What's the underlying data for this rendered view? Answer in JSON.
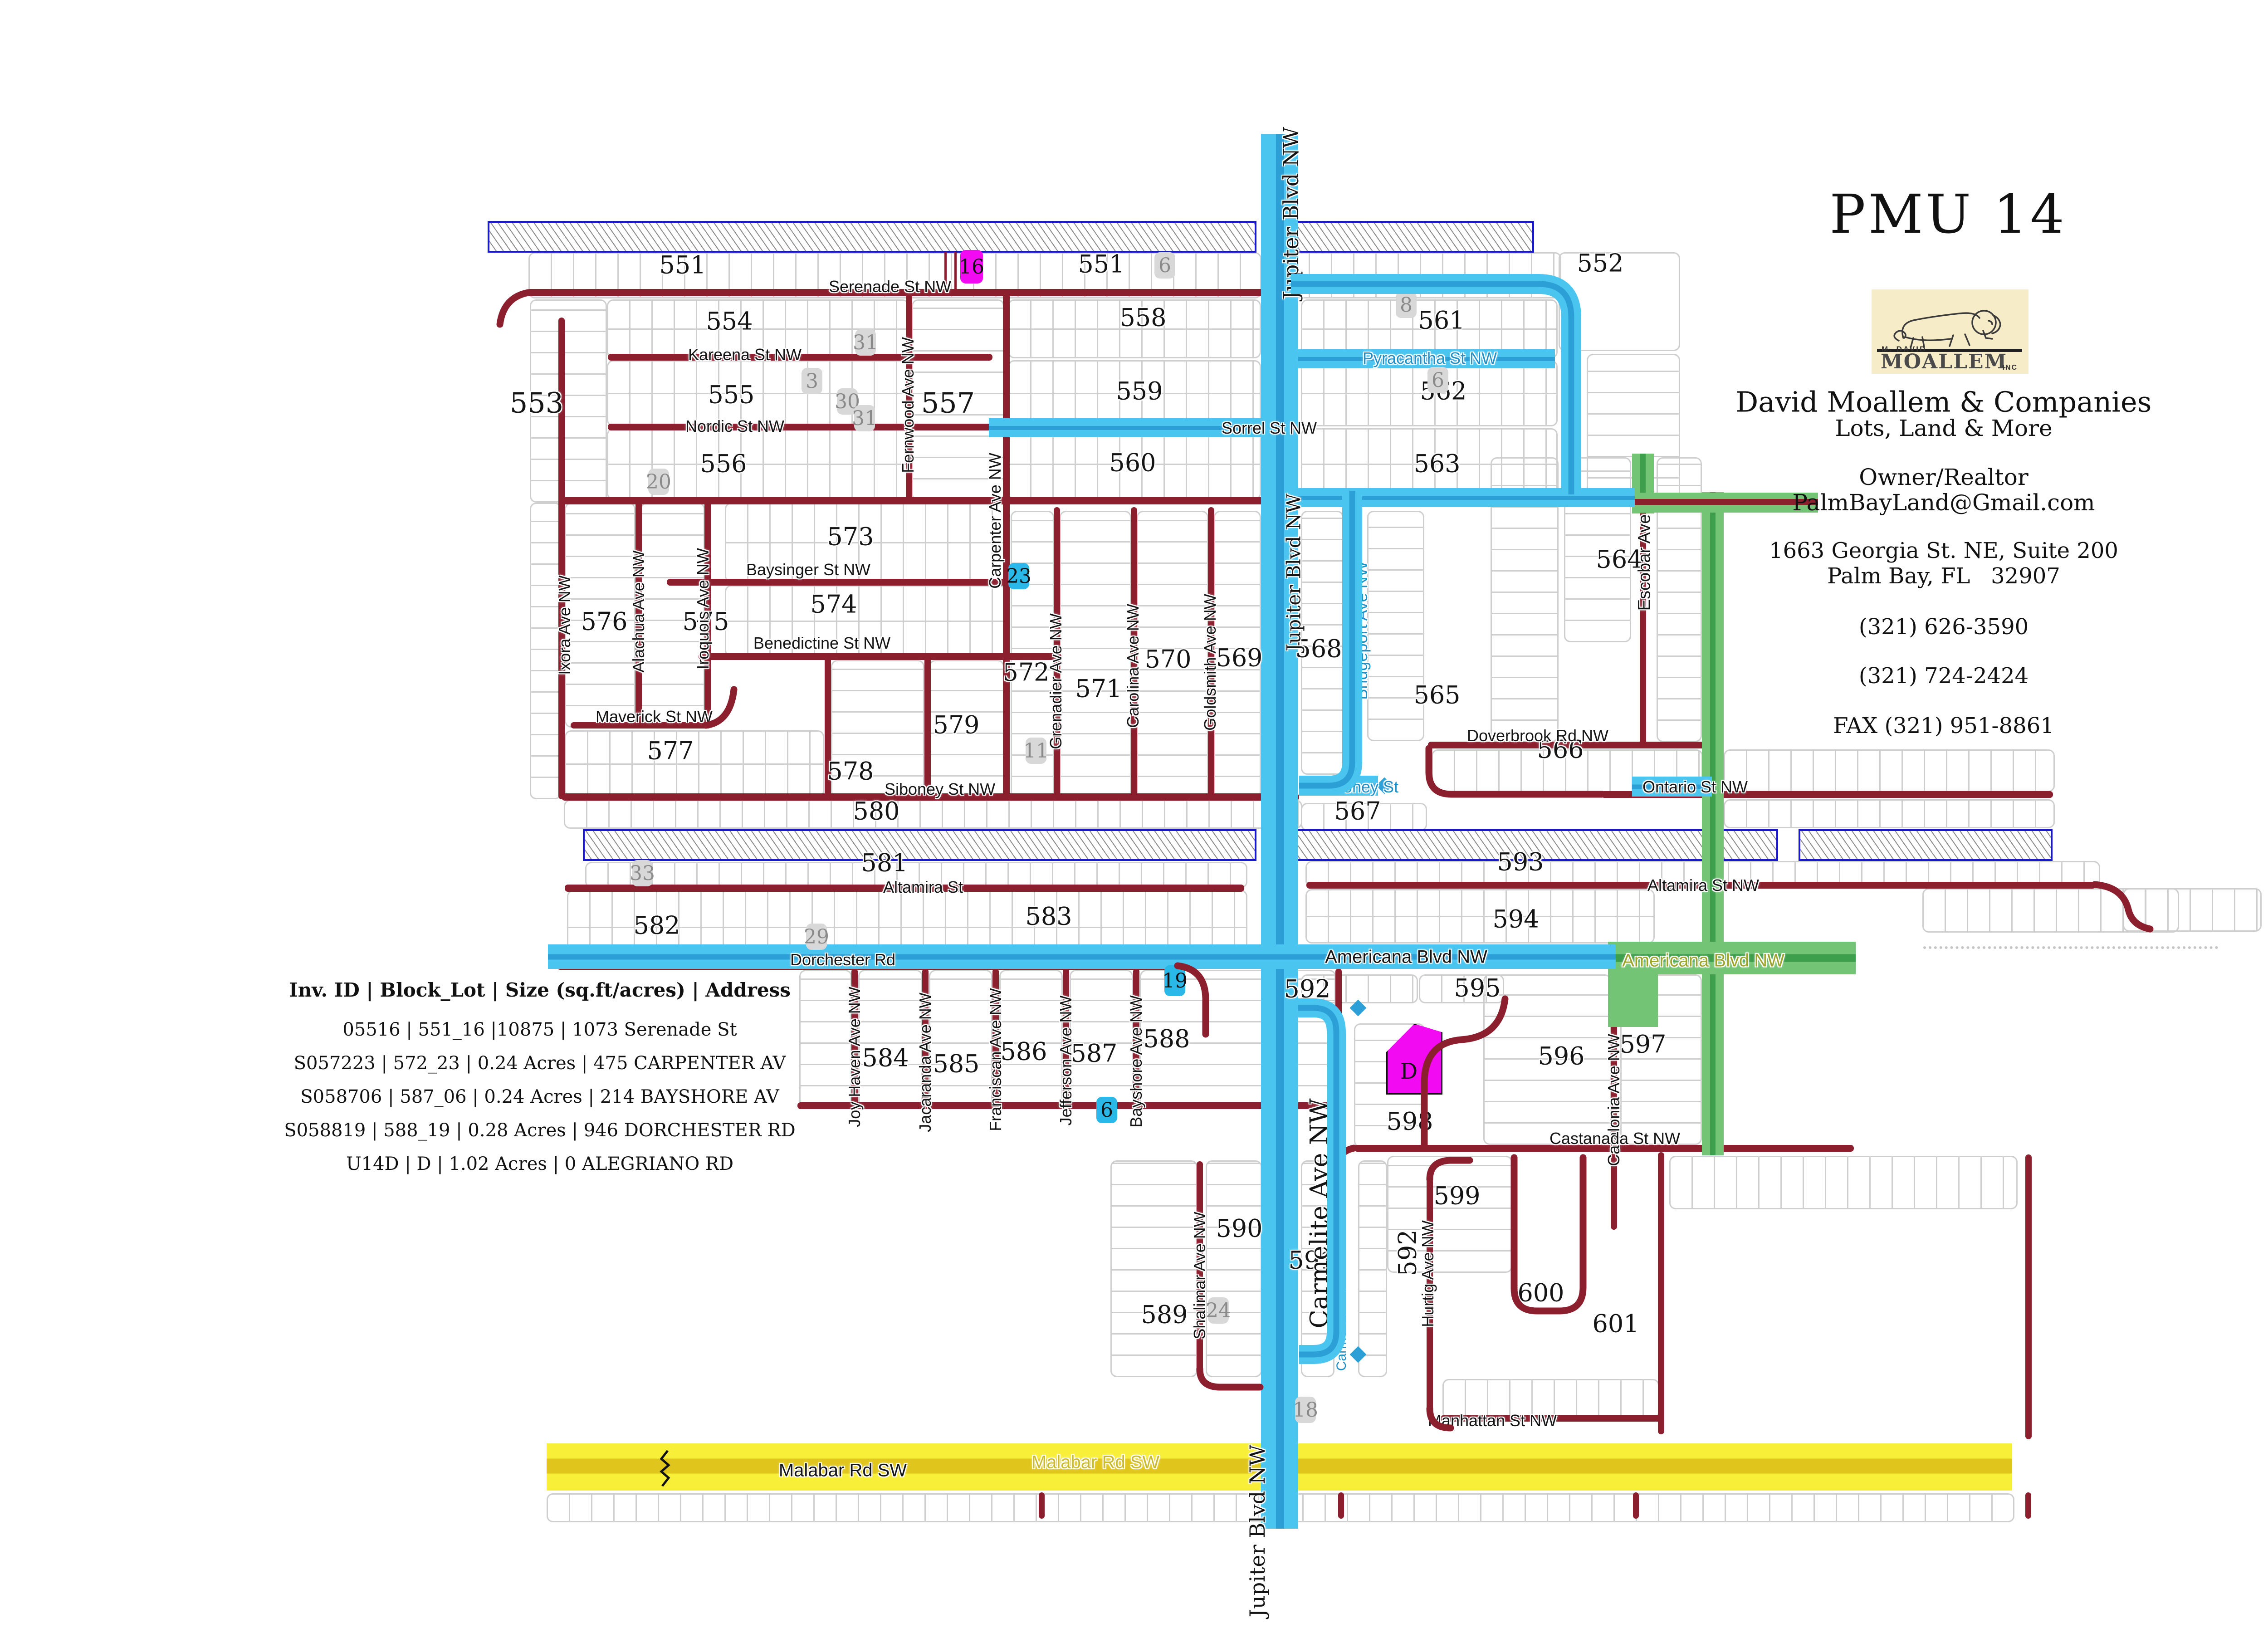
{
  "title": "PMU 14",
  "logo": {
    "top": "M. DAVID",
    "name": "MOALLEM",
    "inc": "INC"
  },
  "company": {
    "lines": [
      "David Moallem & Companies",
      "Lots, Land & More",
      "Owner/Realtor",
      "PalmBayLand@Gmail.com",
      "1663 Georgia St. NE, Suite 200",
      "Palm Bay, FL   32907",
      "(321) 626-3590",
      "(321) 724-2424",
      "FAX (321) 951-8861"
    ]
  },
  "inventory": {
    "header": "Inv. ID | Block_Lot | Size (sq.ft/acres) | Address",
    "rows": [
      "05516 |  551_16 |10875  | 1073 Serenade St",
      "S057223 | 572_23 | 0.24 Acres | 475 CARPENTER AV",
      "S058706 | 587_06 | 0.24 Acres | 214 BAYSHORE AV",
      "S058819 | 588_19 | 0.28 Acres | 946 DORCHESTER RD",
      "U14D | D |  1.02 Acres  | 0 ALEGRIANO RD"
    ]
  },
  "map": {
    "colors": {
      "highlight_blue": "#49C5EF",
      "highlight_blue_core": "#2B9FD6",
      "highlight_green": "#74C475",
      "highlight_green_core": "#3D9E4B",
      "road_red": "#8B1F2E",
      "malabar_yellow": "#F8EF39",
      "malabar_core": "#E0C61C",
      "canal_border_blue": "#1818CF",
      "lot_gray": "#D8D8D8",
      "lot_cyan": "#29B8E8",
      "lot_magenta": "#F20AF2",
      "grid_gray": "#CFCFCF"
    },
    "block_labels": [
      {
        "id": "b551a",
        "text": "551"
      },
      {
        "id": "b551b",
        "text": "551"
      },
      {
        "id": "b552",
        "text": "552"
      },
      {
        "id": "b553",
        "text": "553"
      },
      {
        "id": "b554",
        "text": "554"
      },
      {
        "id": "b555",
        "text": "555"
      },
      {
        "id": "b556",
        "text": "556"
      },
      {
        "id": "b557",
        "text": "557"
      },
      {
        "id": "b558",
        "text": "558"
      },
      {
        "id": "b559",
        "text": "559"
      },
      {
        "id": "b560",
        "text": "560"
      },
      {
        "id": "b561",
        "text": "561"
      },
      {
        "id": "b562",
        "text": "562"
      },
      {
        "id": "b563",
        "text": "563"
      },
      {
        "id": "b564",
        "text": "564"
      },
      {
        "id": "b565",
        "text": "565"
      },
      {
        "id": "b566",
        "text": "566"
      },
      {
        "id": "b567",
        "text": "567"
      },
      {
        "id": "b568",
        "text": "568"
      },
      {
        "id": "b569",
        "text": "569"
      },
      {
        "id": "b570",
        "text": "570"
      },
      {
        "id": "b571",
        "text": "571"
      },
      {
        "id": "b572",
        "text": "572"
      },
      {
        "id": "b573",
        "text": "573"
      },
      {
        "id": "b574",
        "text": "574"
      },
      {
        "id": "b575",
        "text": "575"
      },
      {
        "id": "b576",
        "text": "576"
      },
      {
        "id": "b577",
        "text": "577"
      },
      {
        "id": "b578",
        "text": "578"
      },
      {
        "id": "b579",
        "text": "579"
      },
      {
        "id": "b580",
        "text": "580"
      },
      {
        "id": "b581",
        "text": "581"
      },
      {
        "id": "b582",
        "text": "582"
      },
      {
        "id": "b583",
        "text": "583"
      },
      {
        "id": "b584",
        "text": "584"
      },
      {
        "id": "b585",
        "text": "585"
      },
      {
        "id": "b586",
        "text": "586"
      },
      {
        "id": "b587",
        "text": "587"
      },
      {
        "id": "b588",
        "text": "588"
      },
      {
        "id": "b589",
        "text": "589"
      },
      {
        "id": "b590",
        "text": "590"
      },
      {
        "id": "b591",
        "text": "591"
      },
      {
        "id": "b592a",
        "text": "592"
      },
      {
        "id": "b592b",
        "text": "592"
      },
      {
        "id": "b593",
        "text": "593"
      },
      {
        "id": "b594",
        "text": "594"
      },
      {
        "id": "b595",
        "text": "595"
      },
      {
        "id": "b596",
        "text": "596"
      },
      {
        "id": "b597",
        "text": "597"
      },
      {
        "id": "b598",
        "text": "598"
      },
      {
        "id": "b599",
        "text": "599"
      },
      {
        "id": "b600",
        "text": "600"
      },
      {
        "id": "b601",
        "text": "601"
      }
    ],
    "street_labels": [
      {
        "id": "sSerenade",
        "text": "Serenade St NW"
      },
      {
        "id": "sKareena",
        "text": "Kareena St NW"
      },
      {
        "id": "sNordic",
        "text": "Nordic St NW"
      },
      {
        "id": "sFernwood",
        "text": "Fernwood Ave NW"
      },
      {
        "id": "sCarpenter",
        "text": "Carpenter Ave NW"
      },
      {
        "id": "sBaysinger",
        "text": "Baysinger St NW"
      },
      {
        "id": "sBenedictine",
        "text": "Benedictine St NW"
      },
      {
        "id": "sIxora",
        "text": "Ixora Ave NW"
      },
      {
        "id": "sAlachua",
        "text": "Alachua Ave NW"
      },
      {
        "id": "sIroquois",
        "text": "Iroquois Ave NW"
      },
      {
        "id": "sMaverick",
        "text": "Maverick St NW"
      },
      {
        "id": "sSiboneyNW",
        "text": "Siboney St NW"
      },
      {
        "id": "sGrenadier",
        "text": "Grenadier Ave NW"
      },
      {
        "id": "sCarolina",
        "text": "Carolina Ave NW"
      },
      {
        "id": "sGoldsmith",
        "text": "Goldsmith Ave NW"
      },
      {
        "id": "sJupiterTop",
        "text": "Jupiter Blvd NW"
      },
      {
        "id": "sJupiterMid",
        "text": "Jupiter Blvd NW"
      },
      {
        "id": "sJupiterBot",
        "text": "Jupiter Blvd NW"
      },
      {
        "id": "sBridgeport",
        "text": "Bridgeport Ave NW"
      },
      {
        "id": "sAdventure",
        "text": "Adventure Ave NW"
      },
      {
        "id": "sPyracantha",
        "text": "Pyracantha St NW"
      },
      {
        "id": "sSorrel",
        "text": "Sorrel St NW"
      },
      {
        "id": "sSiboneyBlue",
        "text": "Siboney St"
      },
      {
        "id": "sEscobar",
        "text": "Escobar Ave"
      },
      {
        "id": "sDoverbrook",
        "text": "Doverbrook Rd NW"
      },
      {
        "id": "sOntario",
        "text": "Ontario St NW"
      },
      {
        "id": "sAltamira",
        "text": "Altamira St"
      },
      {
        "id": "sAltamiraNW",
        "text": "Altamira St NW"
      },
      {
        "id": "sDorchester",
        "text": "Dorchester Rd"
      },
      {
        "id": "sAmericanaBlk",
        "text": "Americana Blvd NW"
      },
      {
        "id": "sAmericanaGrn",
        "text": "Americana Blvd NW"
      },
      {
        "id": "sJoyHaven",
        "text": "Joy Haven Ave NW"
      },
      {
        "id": "sJacaranda",
        "text": "Jacaranda Ave NW"
      },
      {
        "id": "sFranciscan",
        "text": "Franciscan Ave NW"
      },
      {
        "id": "sJefferson",
        "text": "Jefferson Ave NW"
      },
      {
        "id": "sBayshore",
        "text": "Bayshore Ave NW"
      },
      {
        "id": "sShalimar",
        "text": "Shalimar Ave NW"
      },
      {
        "id": "sCarmeliteBig",
        "text": "Carmelite Ave NW"
      },
      {
        "id": "sCarmeliteBlue",
        "text": "Carmelite Ave NW"
      },
      {
        "id": "sCatalonia",
        "text": "Catalonia Ave NW"
      },
      {
        "id": "sHurtig",
        "text": "Hurtig Ave NW"
      },
      {
        "id": "sCastanada",
        "text": "Castanada St NW"
      },
      {
        "id": "sManhattan",
        "text": "Manhattan St NW"
      },
      {
        "id": "sMalabarBlk",
        "text": "Malabar Rd SW"
      },
      {
        "id": "sMalabarOlv",
        "text": "Malabar Rd SW"
      }
    ],
    "lot_markers": [
      {
        "id": "m16",
        "text": "16",
        "type": "magenta"
      },
      {
        "id": "m6a",
        "text": "6",
        "type": "gray"
      },
      {
        "id": "m8",
        "text": "8",
        "type": "gray"
      },
      {
        "id": "m31a",
        "text": "31",
        "type": "gray"
      },
      {
        "id": "m3",
        "text": "3",
        "type": "gray"
      },
      {
        "id": "m30",
        "text": "30",
        "type": "gray"
      },
      {
        "id": "m31b",
        "text": "31",
        "type": "gray"
      },
      {
        "id": "m6b",
        "text": "6",
        "type": "gray"
      },
      {
        "id": "m20",
        "text": "20",
        "type": "gray"
      },
      {
        "id": "m23",
        "text": "23",
        "type": "cyan"
      },
      {
        "id": "m11",
        "text": "11",
        "type": "gray"
      },
      {
        "id": "m33",
        "text": "33",
        "type": "gray"
      },
      {
        "id": "m29",
        "text": "29",
        "type": "gray"
      },
      {
        "id": "m19",
        "text": "19",
        "type": "cyan"
      },
      {
        "id": "m6c",
        "text": "6",
        "type": "cyan"
      },
      {
        "id": "m24",
        "text": "24",
        "type": "gray"
      },
      {
        "id": "m18",
        "text": "18",
        "type": "gray"
      },
      {
        "id": "mD",
        "text": "D",
        "type": "magenta-shape"
      }
    ]
  }
}
